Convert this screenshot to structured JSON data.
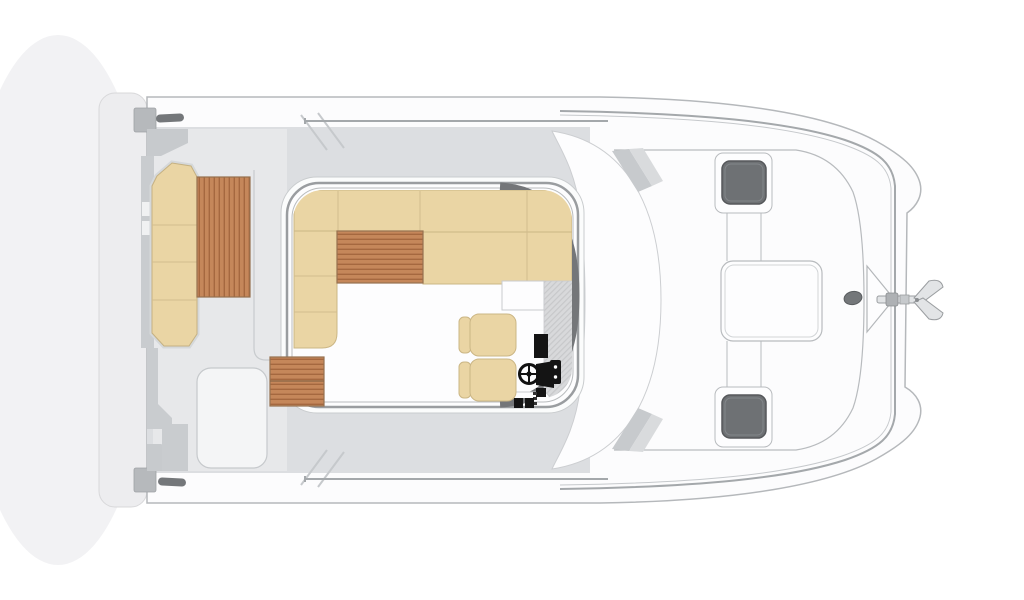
{
  "page": {
    "label": "Power catamaran deck plan, top-down view, bow facing right",
    "background": "#ffffff"
  },
  "colors": {
    "background": "#ffffff",
    "shadow": "#f2f2f4",
    "hull": "#fcfcfd",
    "hull_line": "#b5b8bb",
    "platform": "#ededef",
    "platform_line": "#d8d8da",
    "deck_gray": "#dcdee1",
    "cockpit_gray": "#e7e8ea",
    "molding_line": "#c8cbce",
    "gray_band": "#c9cccf",
    "gray_block": "#b6b9bc",
    "notch_light": "#f0f1f2",
    "wedge_dark": "#c7cacd",
    "wedge_light": "#d9dbdd",
    "rail": "#a4a8ab",
    "rail_light": "#c6c9cc",
    "wall_line": "#9a9da0",
    "wall_inner": "#b9bcbe",
    "wall_dark": "#747679",
    "rim_line": "#c9ccce",
    "floor_white": "#fdfdfe",
    "cushion": "#ead5a4",
    "cushion_edge": "#c5b182",
    "cushion_seam": "#d2bd8e",
    "teak": "#c5875a",
    "teak_stripe": "#a5683f",
    "teak_edge": "#96714f",
    "hatch_dark": "#6e7174",
    "hatch_edge": "#56585b",
    "frame_line": "#b8bbbe",
    "metal_dark": "#74777a",
    "metal_edge": "#595c5f",
    "console_black": "#141414",
    "dash_gray": "#d8d9db",
    "dash_line": "#c7c8ca",
    "anchor_fill": "#e2e4e6",
    "anchor_line": "#9b9ea1",
    "dot_white": "#ffffff"
  },
  "parts": {
    "swim_platform": "swim platform",
    "stern_cleat": "mooring cleat",
    "transom_bench": "aft cockpit bench",
    "cockpit_table": "cockpit teak table",
    "cockpit": "aft cockpit",
    "side_deck": "side deck",
    "railing": "deck railing",
    "salon": "salon",
    "sofa": "U-shaped dinette sofa",
    "salon_table": "salon teak table",
    "entry_steps": "companionway teak steps",
    "helm_seat": "helm seat",
    "helm_console": "helm console",
    "steering_wheel": "steering wheel",
    "galley_counter": "galley counter",
    "windshield": "windshield coachroof",
    "foredeck": "foredeck",
    "deck_hatch": "deck hatch",
    "center_hatch": "central deck locker",
    "bow_pulpit": "bow pulpit",
    "windlass": "anchor windlass",
    "anchor": "anchor"
  }
}
